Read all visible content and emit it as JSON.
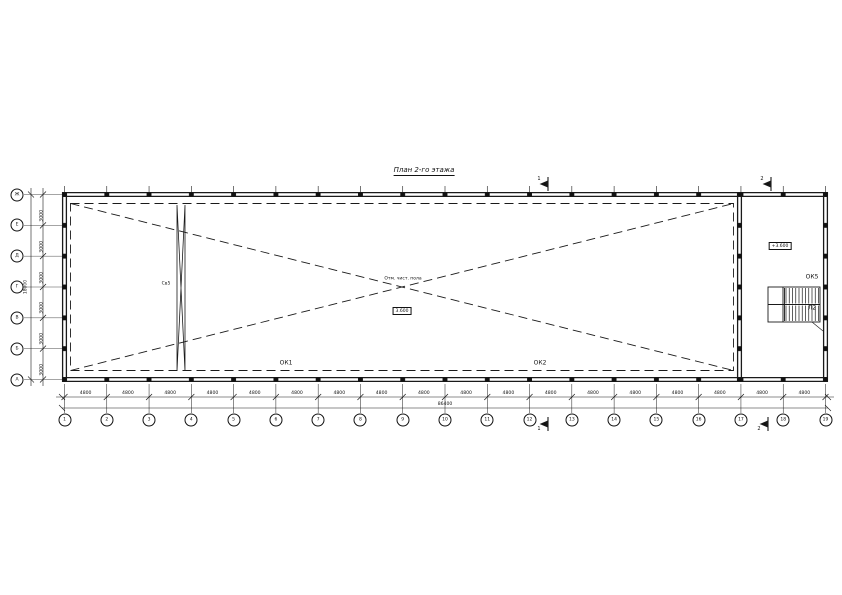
{
  "page": {
    "title": "План 2-го этажа"
  },
  "colors": {
    "line": "#1a1a1a",
    "background": "#ffffff",
    "text": "#111111"
  },
  "axes_bottom": {
    "labels": [
      "1",
      "2",
      "3",
      "4",
      "5",
      "6",
      "7",
      "8",
      "9",
      "10",
      "11",
      "12",
      "13",
      "14",
      "15",
      "16",
      "17",
      "18",
      "19"
    ],
    "bay_dims": [
      "4800",
      "4800",
      "4800",
      "4800",
      "4800",
      "4800",
      "4800",
      "4800",
      "4800",
      "4800",
      "4800",
      "4800",
      "4800",
      "4800",
      "4800",
      "4800",
      "4800",
      "4800"
    ],
    "total_dim": "86400"
  },
  "axes_left": {
    "labels": [
      "Ж",
      "Е",
      "Д",
      "Г",
      "В",
      "Б",
      "А"
    ],
    "bay_dims": [
      "3000",
      "3000",
      "3000",
      "3000",
      "3000",
      "3000"
    ],
    "total_dim": "18000"
  },
  "annotations": {
    "window_1": "ОК1",
    "window_2": "ОК2",
    "window_5": "ОК5",
    "stairs": "Л2",
    "bracing": "Св5",
    "center_note": "Отм. чист. пола",
    "center_level": "3.600",
    "stair_level": "+3.600",
    "section_1": "1",
    "section_2": "2"
  }
}
